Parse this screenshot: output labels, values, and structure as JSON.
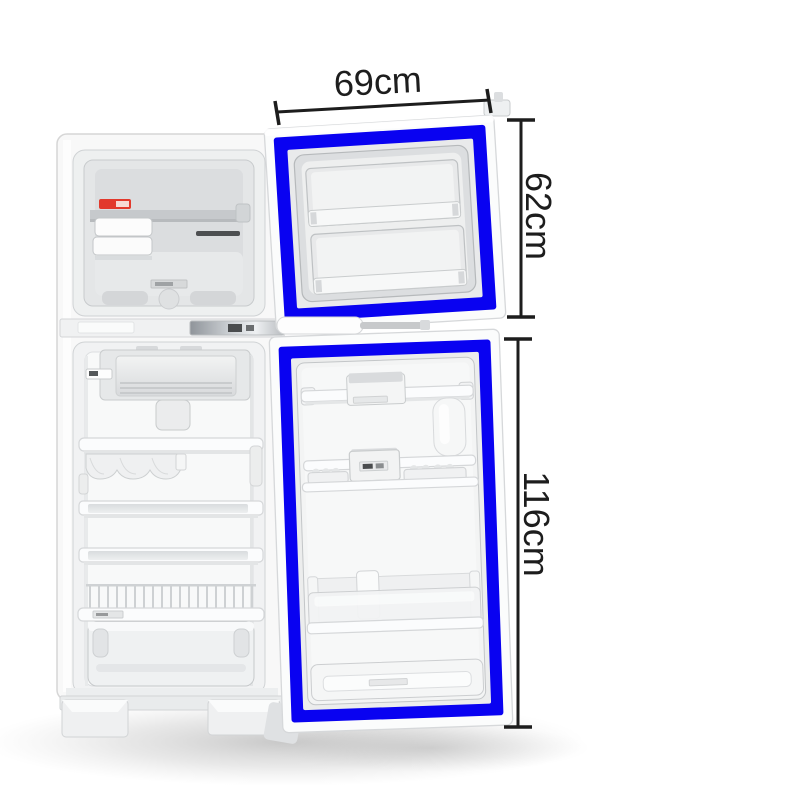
{
  "image": {
    "title": "Refrigerator door gasket measurement diagram",
    "subject": "Two-door top-freezer refrigerator shown open with blue door gasket seals highlighted",
    "background": "#ffffff"
  },
  "colors": {
    "gasket_blue": "#0902f1",
    "dimension_ink": "#1d1d1d",
    "freezer_label_red": "#e2392c"
  },
  "annotations": {
    "door_width": {
      "label": "69cm"
    },
    "freezer_door_height": {
      "label": "62cm"
    },
    "fridge_door_height": {
      "label": "116cm"
    }
  }
}
